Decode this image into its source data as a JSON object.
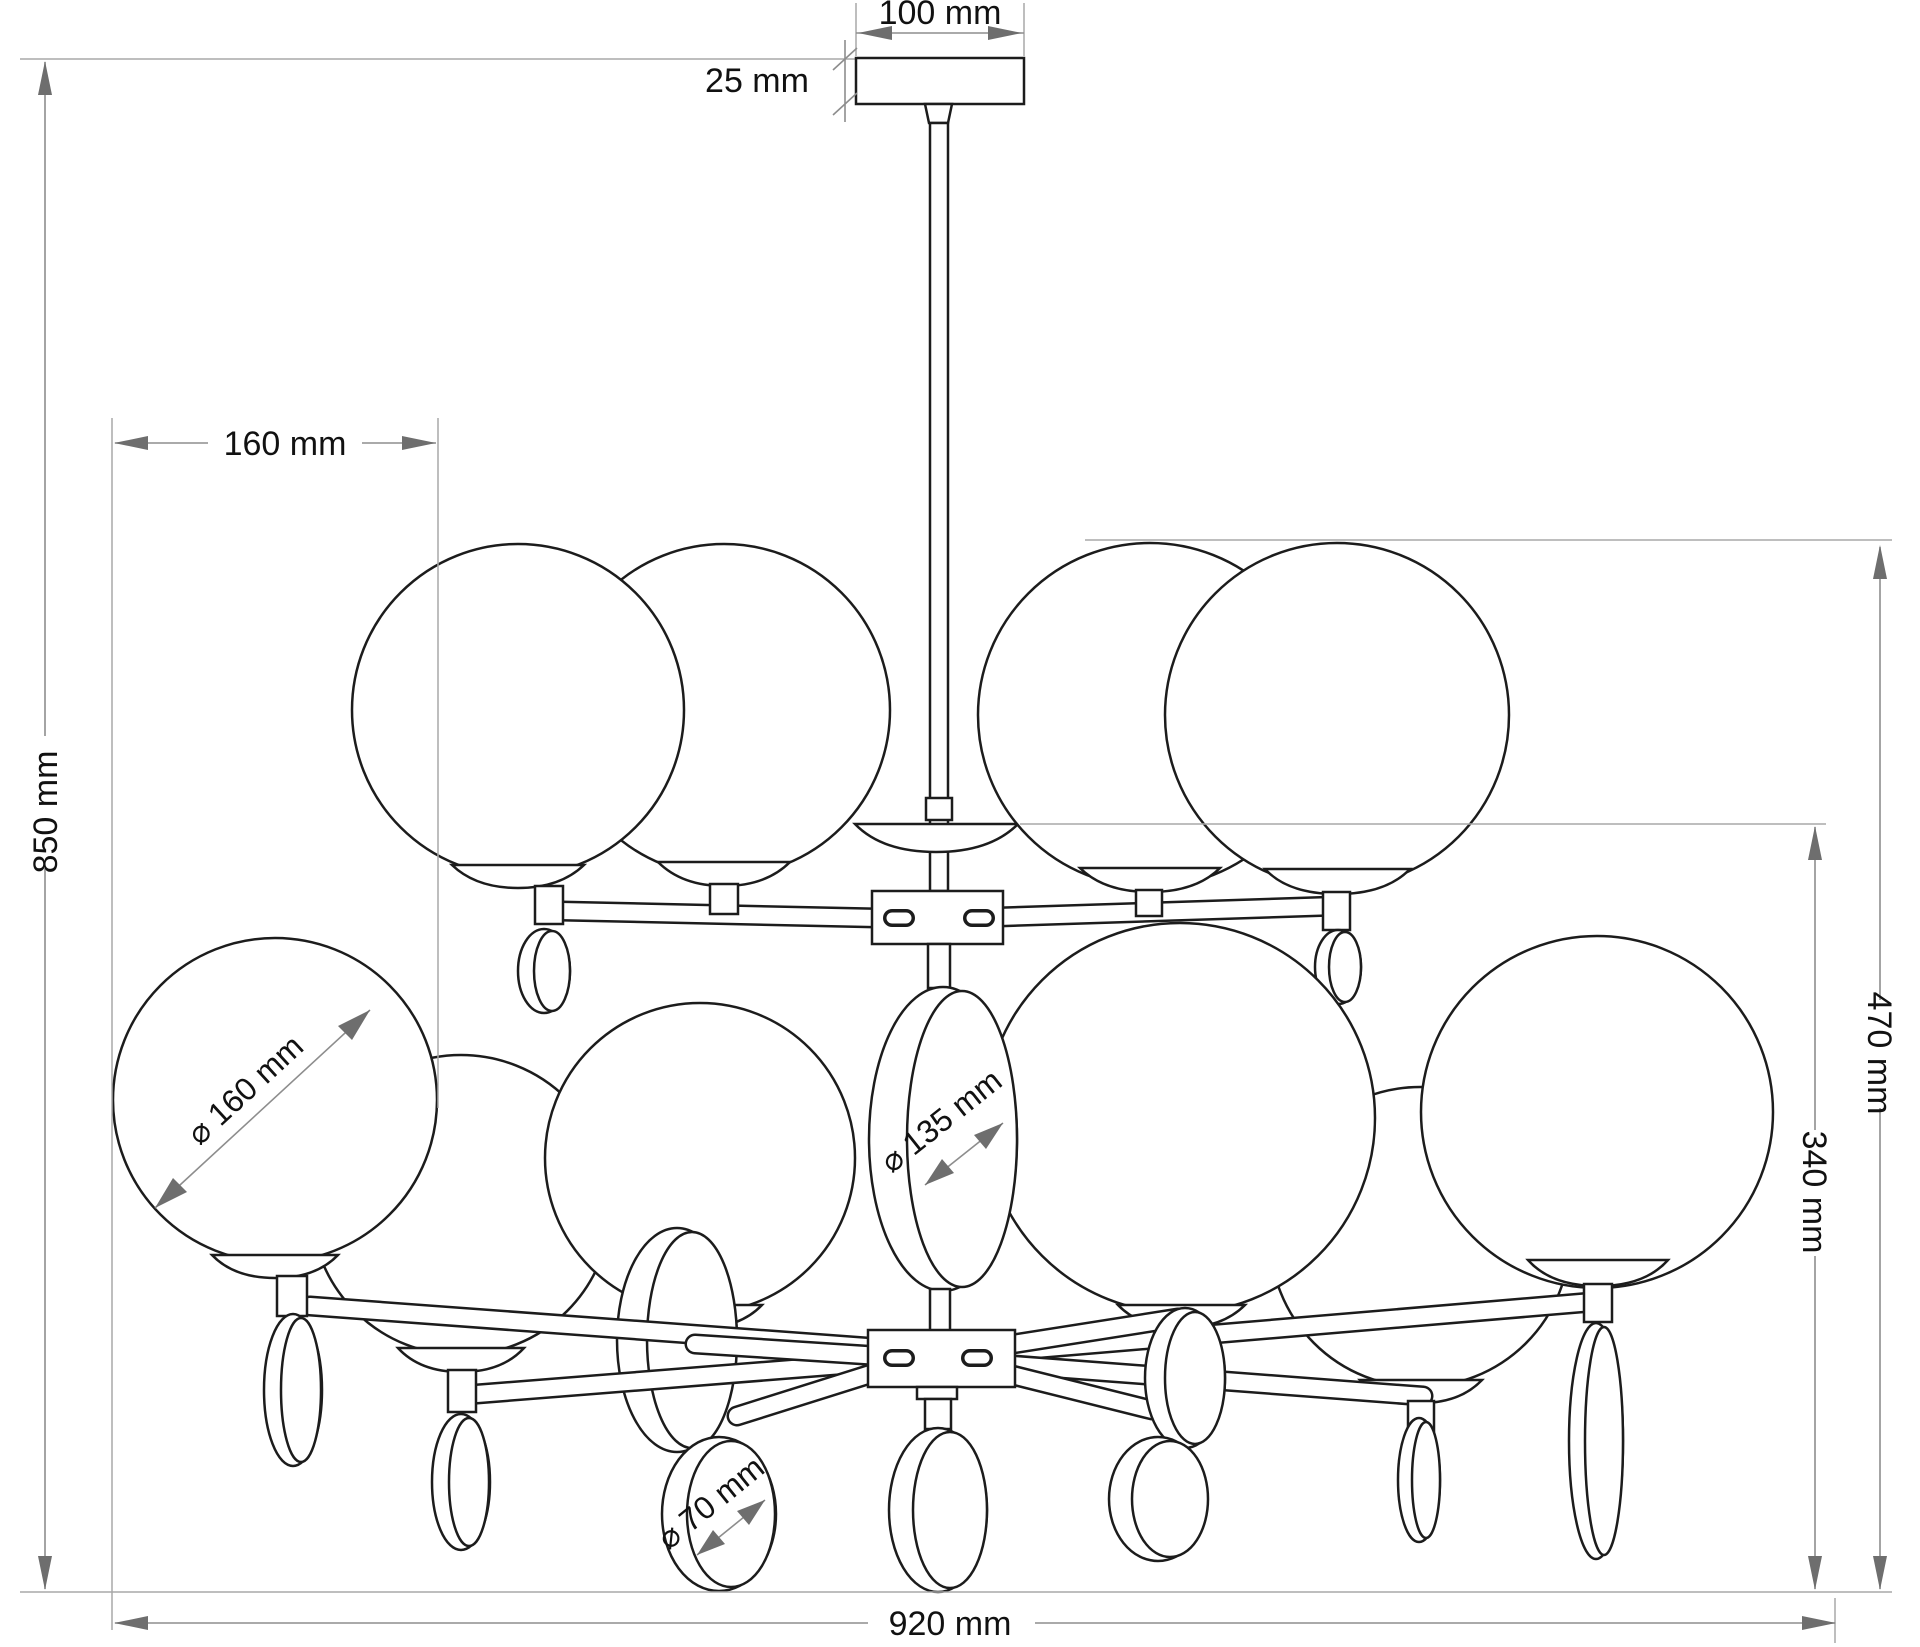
{
  "drawing": {
    "title": "Chandelier dimensioned technical drawing",
    "labels": {
      "canopy_width": "100 mm",
      "canopy_height": "25 mm",
      "globe_pitch": "160 mm",
      "overall_height": "850 mm",
      "body_height": "470 mm",
      "lower_tier_height": "340 mm",
      "overall_width": "920 mm",
      "globe_diameter": "⌀ 160 mm",
      "center_disc_diameter": "⌀ 135 mm",
      "small_disc_diameter": "⌀ 70 mm"
    },
    "colors": {
      "background": "#ffffff",
      "outline": "#1c1c1c",
      "dimension_line": "#8d8d8d",
      "arrowhead": "#6e6e6e",
      "text": "#111111"
    }
  }
}
